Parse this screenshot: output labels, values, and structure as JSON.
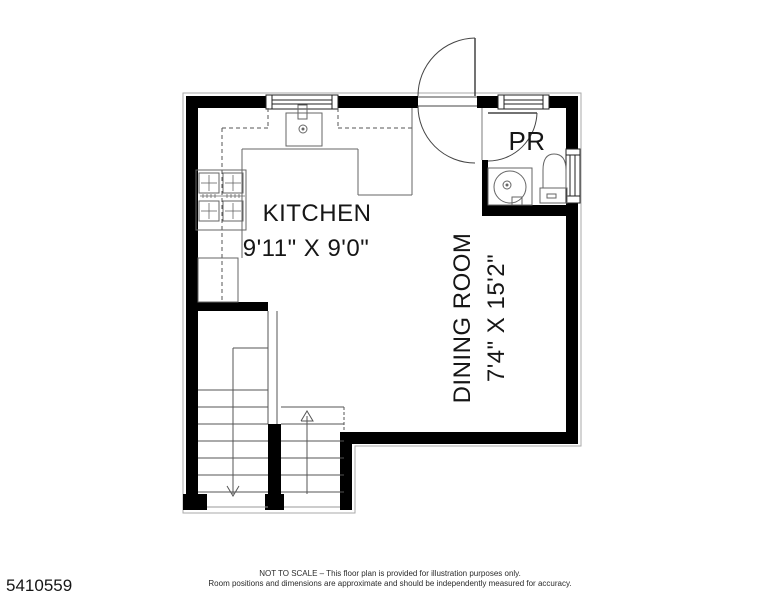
{
  "plan": {
    "rooms": [
      {
        "name": "KITCHEN",
        "dimensions": "9'11\" X 9'0\""
      },
      {
        "name": "DINING ROOM",
        "dimensions": "7'4\" X 15'2\""
      },
      {
        "name": "PR",
        "dimensions": ""
      }
    ],
    "fixtures": [
      "kitchen-sink",
      "stove",
      "refrigerator",
      "counter",
      "upper-cabinets-dashed",
      "powder-room-sink",
      "toilet",
      "entry-door-double-swing",
      "pr-door",
      "window-top-kitchen",
      "window-top-pr",
      "window-right-dining",
      "stairs-up",
      "stairs-down"
    ],
    "colors": {
      "wall": "#000000",
      "fixture_line": "#666666",
      "thin_line": "#555555",
      "outline": "#aaaaaa",
      "text": "#161616",
      "background": "#ffffff"
    }
  },
  "footer": {
    "listing_id": "5410559",
    "disclaimer_line1": "NOT TO SCALE – This floor plan is provided for illustration purposes only.",
    "disclaimer_line2": "Room positions and dimensions are approximate and should be independently measured for accuracy."
  }
}
